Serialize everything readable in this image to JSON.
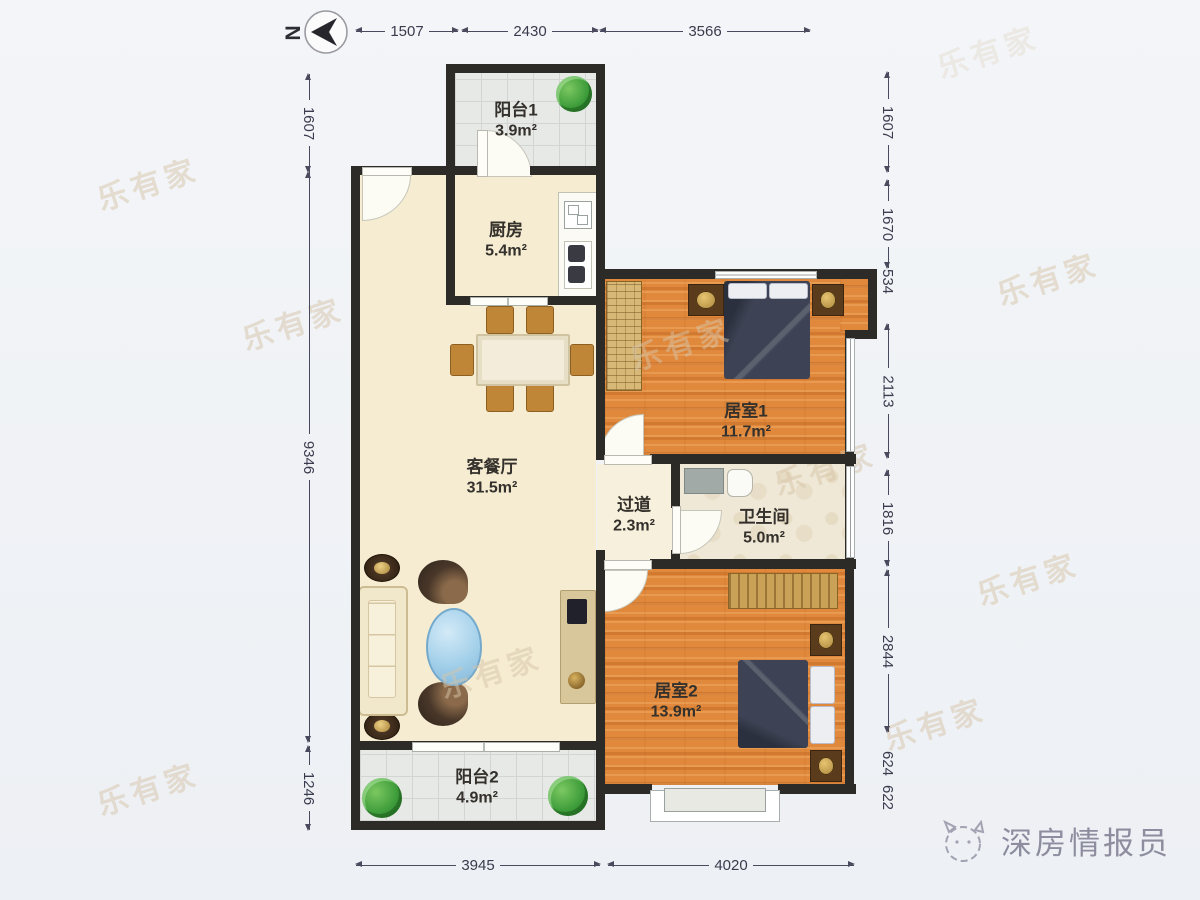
{
  "north_label": "N",
  "watermark": "乐有家",
  "brand": {
    "name": "深房情报员"
  },
  "rooms": [
    {
      "name": "阳台1",
      "area": "3.9m²"
    },
    {
      "name": "厨房",
      "area": "5.4m²"
    },
    {
      "name": "客餐厅",
      "area": "31.5m²"
    },
    {
      "name": "居室1",
      "area": "11.7m²"
    },
    {
      "name": "过道",
      "area": "2.3m²"
    },
    {
      "name": "卫生间",
      "area": "5.0m²"
    },
    {
      "name": "居室2",
      "area": "13.9m²"
    },
    {
      "name": "阳台2",
      "area": "4.9m²"
    }
  ],
  "dims": {
    "top": [
      "1507",
      "2430",
      "3566"
    ],
    "bottom": [
      "3945",
      "4020"
    ],
    "left": [
      "1607",
      "9346",
      "1246"
    ],
    "right": [
      "1607",
      "1670",
      "534",
      "2113",
      "1816",
      "2844",
      "624",
      "622"
    ]
  }
}
